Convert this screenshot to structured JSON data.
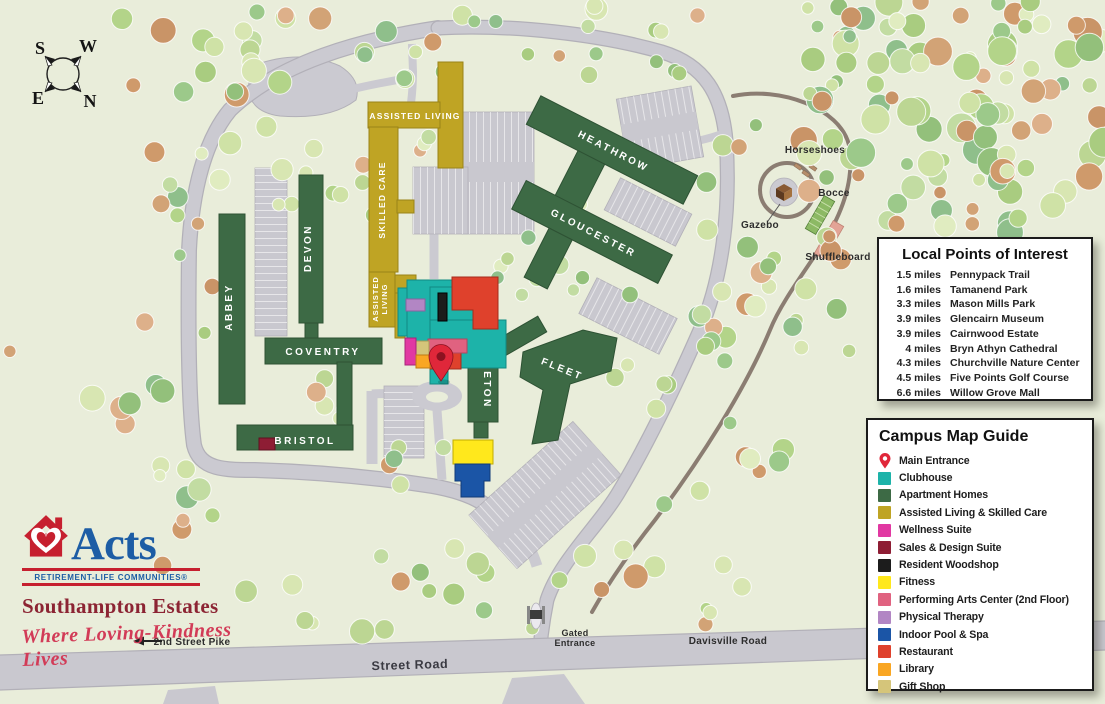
{
  "compass": {
    "top_left": "S",
    "top_right": "W",
    "bottom_left": "E",
    "bottom_right": "N"
  },
  "buildings": {
    "abbey": "ABBEY",
    "devon": "DEVON",
    "coventry": "COVENTRY",
    "bristol": "BRISTOL",
    "eton": "ETON",
    "heathrow": "HEATHROW",
    "gloucester": "GLOUCESTER",
    "fleet": "FLEET",
    "assisted_living": "ASSISTED LIVING",
    "skilled_care": "SKILLED CARE",
    "assisted_living_lower_1": "ASSISTED",
    "assisted_living_lower_2": "LIVING"
  },
  "map_labels": {
    "street_road": "Street Road",
    "second_street_pike": "2nd Street Pike",
    "davisville_road": "Davisville Road",
    "gated_entrance_line1": "Gated",
    "gated_entrance_line2": "Entrance",
    "horseshoes": "Horseshoes",
    "bocce": "Bocce",
    "gazebo": "Gazebo",
    "shuffleboard": "Shuffleboard"
  },
  "poi_panel": {
    "title": "Local Points of Interest",
    "items": [
      {
        "distance": "1.5 miles",
        "name": "Pennypack Trail"
      },
      {
        "distance": "1.6 miles",
        "name": "Tamanend Park"
      },
      {
        "distance": "3.3 miles",
        "name": "Mason Mills Park"
      },
      {
        "distance": "3.9 miles",
        "name": "Glencairn Museum"
      },
      {
        "distance": "3.9 miles",
        "name": "Cairnwood Estate"
      },
      {
        "distance": "4 miles",
        "name": "Bryn Athyn Cathedral"
      },
      {
        "distance": "4.3 miles",
        "name": "Churchville Nature Center"
      },
      {
        "distance": "4.5 miles",
        "name": "Five Points Golf Course"
      },
      {
        "distance": "6.6 miles",
        "name": "Willow Grove Mall"
      }
    ]
  },
  "legend_panel": {
    "title": "Campus Map Guide",
    "items": [
      {
        "label": "Main Entrance",
        "color": "#e0273a",
        "swatch": "pin"
      },
      {
        "label": "Clubhouse",
        "color": "#1db3a9",
        "swatch": "square"
      },
      {
        "label": "Apartment Homes",
        "color": "#3d6a45",
        "swatch": "square"
      },
      {
        "label": "Assisted Living & Skilled Care",
        "color": "#bfa424",
        "swatch": "square"
      },
      {
        "label": "Wellness Suite",
        "color": "#e138a2",
        "swatch": "square"
      },
      {
        "label": "Sales & Design Suite",
        "color": "#8e1d34",
        "swatch": "square"
      },
      {
        "label": "Resident Woodshop",
        "color": "#1c1c1c",
        "swatch": "square"
      },
      {
        "label": "Fitness",
        "color": "#ffe81c",
        "swatch": "square"
      },
      {
        "label": "Performing Arts Center (2nd Floor)",
        "color": "#e06280",
        "swatch": "square"
      },
      {
        "label": "Physical Therapy",
        "color": "#b286c4",
        "swatch": "square"
      },
      {
        "label": "Indoor Pool & Spa",
        "color": "#1b55a6",
        "swatch": "square"
      },
      {
        "label": "Restaurant",
        "color": "#df412c",
        "swatch": "square"
      },
      {
        "label": "Library",
        "color": "#f9a623",
        "swatch": "square"
      },
      {
        "label": "Gift Shop",
        "color": "#d5c57a",
        "swatch": "square"
      }
    ]
  },
  "branding": {
    "name": "Acts",
    "subtitle": "RETIREMENT-LIFE COMMUNITIES®",
    "community": "Southampton Estates",
    "tagline": "Where Loving-Kindness Lives"
  }
}
